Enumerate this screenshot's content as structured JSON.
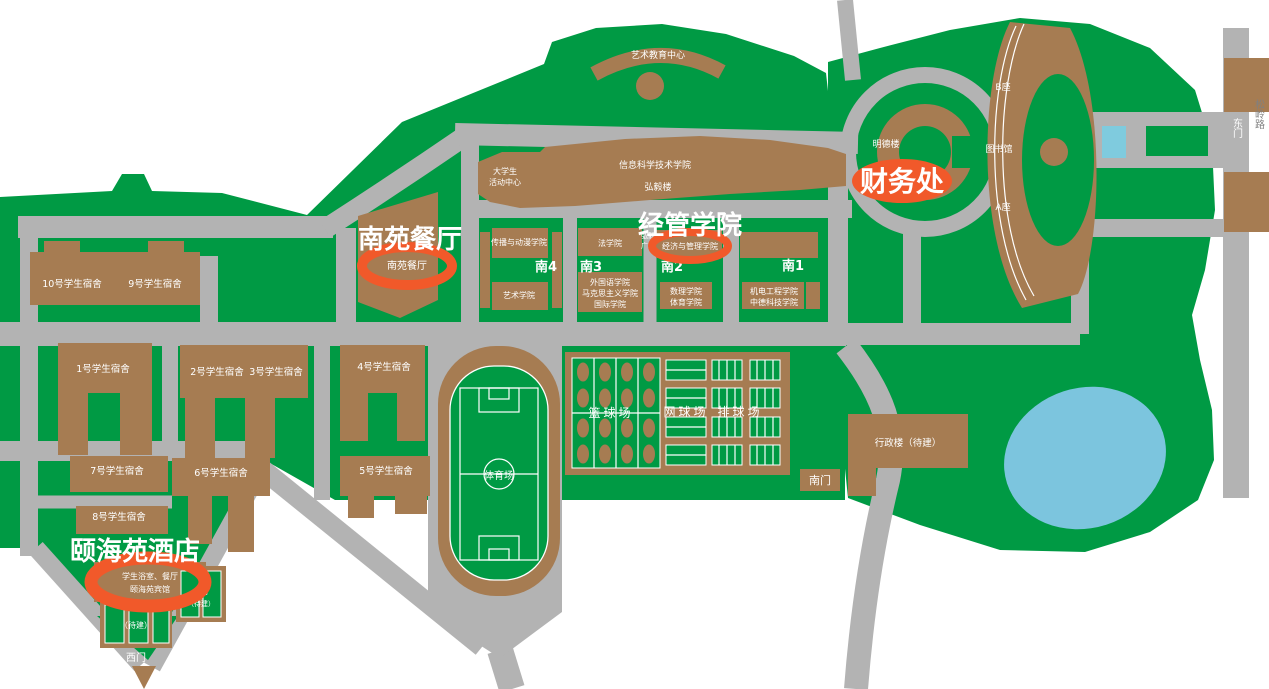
{
  "colors": {
    "campus_green": "#009A44",
    "road_gray": "#B3B3B3",
    "building_brown": "#A67C52",
    "highlight_orange": "#F1592A",
    "lake_blue": "#7CC5DE",
    "pool_cyan": "#7FCBDE",
    "street_text_gray": "#808080"
  },
  "highlights": {
    "canteen": {
      "title": "南苑餐厅",
      "building": "南苑餐厅"
    },
    "business_school": {
      "title": "经管学院",
      "building": "经济与管理学院"
    },
    "finance_office": {
      "title": "财务处"
    },
    "hotel": {
      "title": "颐海苑酒店",
      "line1": "学生浴室、餐厅",
      "line2": "颐海苑宾馆"
    }
  },
  "gates": {
    "east": "东门",
    "south": "南门",
    "west": "西门"
  },
  "street": "松岭路",
  "buildings": {
    "arts_center": "艺术教育中心",
    "student_center_line1": "大学生",
    "student_center_line2": "活动中心",
    "info_tech_college": "信息科学技术学院",
    "hongyi_building": "弘毅楼",
    "hongyi_square_line1": "弘毅",
    "hongyi_square_line2": "广场",
    "mingde_building": "明德楼",
    "block_b": "B座",
    "library": "图书馆",
    "block_a": "A座",
    "communication_college": "传播与动漫学院",
    "art_college": "艺术学院",
    "law_school": "法学院",
    "foreign_lang_college": "外国语学院",
    "marxism_college": "马克思主义学院",
    "intl_college": "国际学院",
    "math_science_college": "数理学院",
    "pe_college": "体育学院",
    "mech_eng_college": "机电工程学院",
    "sino_german_college": "中德科技学院",
    "admin_building": "行政楼（待建）",
    "south4": "南4",
    "south3": "南3",
    "south2": "南2",
    "south1": "南1"
  },
  "dorms": {
    "d1": "1号学生宿舍",
    "d2": "2号学生宿舍",
    "d3": "3号学生宿舍",
    "d4": "4号学生宿舍",
    "d5": "5号学生宿舍",
    "d6": "6号学生宿舍",
    "d7": "7号学生宿舍",
    "d8": "8号学生宿舍",
    "d9": "9号学生宿舍",
    "d10": "10号学生宿舍"
  },
  "sports": {
    "stadium": "体育场",
    "basketball": "篮球场",
    "tennis": "网球场",
    "volleyball": "排球场",
    "tbd": "（待建）",
    "court_tbd_line1": "球场",
    "court_tbd_line2": "（待建）"
  }
}
